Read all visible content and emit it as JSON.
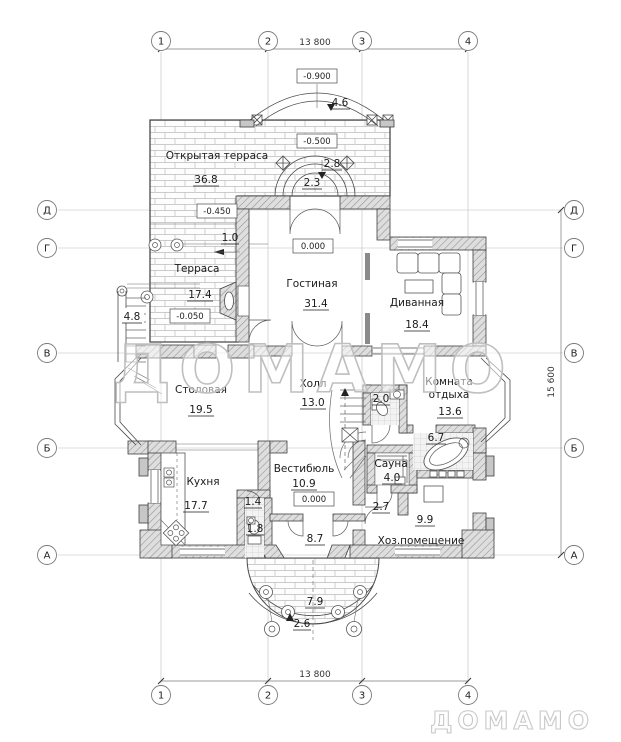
{
  "watermark": {
    "center": "ДОМАМО",
    "corner": "ДОМАМО"
  },
  "grid": {
    "top_dim": "13 800",
    "bottom_dim": "13 800",
    "side_dim": "15 600",
    "cols": {
      "c1": "1",
      "c2": "2",
      "c3": "3",
      "c4": "4"
    },
    "rows": {
      "rD": "Д",
      "rG": "Г",
      "rV": "В",
      "rB": "Б",
      "rA": "А"
    }
  },
  "elevations": {
    "balcony": "-0.900",
    "upper_terrace": "-0.500",
    "terrace_step": "-0.450",
    "living": "0.000",
    "terrace": "-0.050",
    "vestibule": "0.000"
  },
  "rooms": {
    "open_terrace": {
      "name": "Открытая терраса",
      "area": "36.8"
    },
    "terrace": {
      "name": "Терраса",
      "area": "17.4"
    },
    "living": {
      "name": "Гостиная",
      "area": "31.4"
    },
    "sofa_room": {
      "name": "Диванная",
      "area": "18.4"
    },
    "dining": {
      "name": "Столовая",
      "area": "19.5"
    },
    "hall": {
      "name": "Холл",
      "area": "13.0"
    },
    "rest_room": {
      "name": "Комната отдыха",
      "line1": "Комната",
      "line2": "отдыха",
      "area": "13.6"
    },
    "kitchen": {
      "name": "Кухня",
      "area": "17.7"
    },
    "vestibule": {
      "name": "Вестибюль",
      "area": "10.9"
    },
    "sauna": {
      "name": "Сауна",
      "area": "4.0"
    },
    "utility": {
      "name": "Хоз.помещение",
      "area": "9.9"
    }
  },
  "areas": {
    "balcony": "4.6",
    "entry_arc_top": "2.8",
    "entry_arc": "2.3",
    "terrace_step_width": "1.0",
    "side_stairs": "4.8",
    "wc_top": "2.0",
    "bath": "6.7",
    "closet": "1.4",
    "wc_bottom": "1.8",
    "sauna_corridor": "2.7",
    "tambour": "8.7",
    "porch": "7.9",
    "porch_steps": "2.6"
  }
}
